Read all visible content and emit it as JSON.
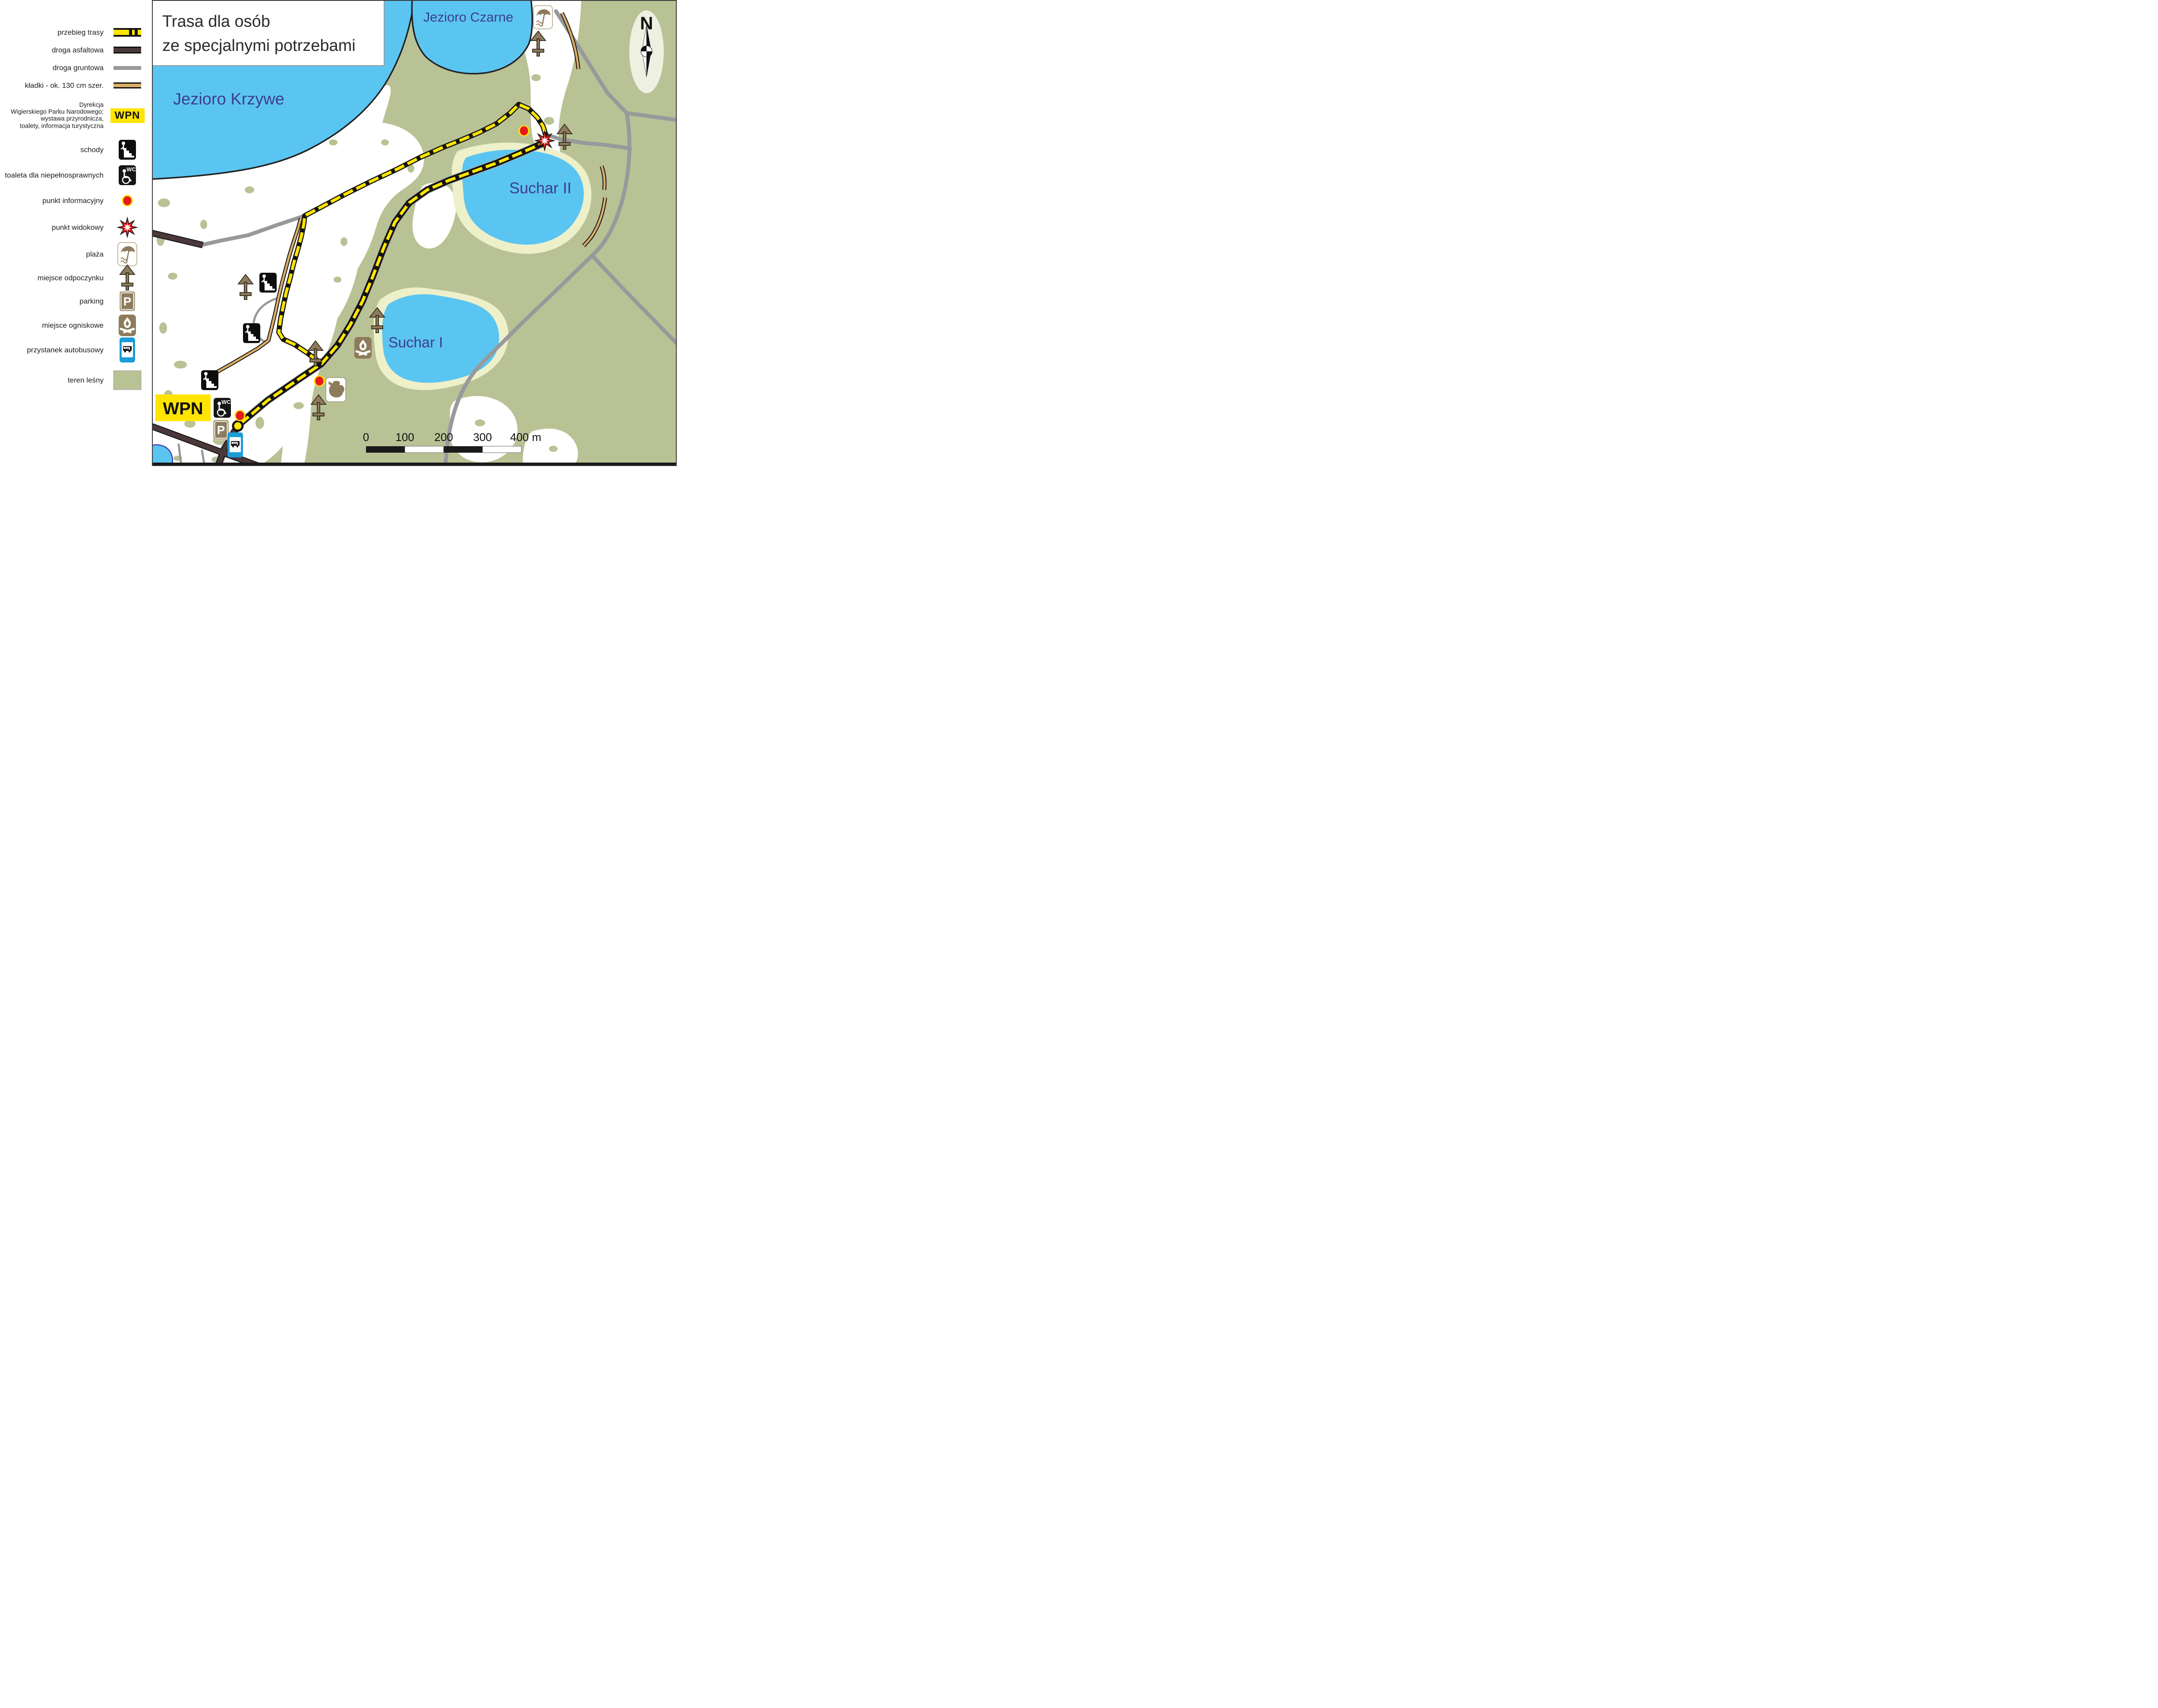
{
  "title": {
    "line1": "Trasa dla osób",
    "line2": "ze specjalnymi potrzebami"
  },
  "legend": {
    "items": [
      {
        "label": "przebieg trasy"
      },
      {
        "label": "droga asfaltowa"
      },
      {
        "label": "droga gruntowa"
      },
      {
        "label": "kładki - ok. 130 cm szer."
      },
      {
        "label": "Dyrekcja Wigierskiego Parku Narodowego: wystawa przyrodnicza, toalety, informacja turystyczna",
        "lines": [
          "Dyrekcja",
          "Wigierskiego Parku Narodowego:",
          "wystawa przyrodnicza,",
          "toalety, informacja turystyczna"
        ],
        "badge": "WPN"
      },
      {
        "label": "schody"
      },
      {
        "label": "toaleta dla niepełnosprawnych",
        "icon_text": "WC"
      },
      {
        "label": "punkt informacyjny"
      },
      {
        "label": "punkt widokowy"
      },
      {
        "label": "plaża"
      },
      {
        "label": "miejsce odpoczynku"
      },
      {
        "label": "parking",
        "icon_text": "P"
      },
      {
        "label": "miejsce ogniskowe"
      },
      {
        "label": "przystanek autobusowy"
      },
      {
        "label": "teren leśny"
      }
    ]
  },
  "map": {
    "labels": {
      "jezioro_krzywe": "Jezioro Krzywe",
      "jezioro_czarne": "Jezioro Czarne",
      "suchar_2": "Suchar II",
      "suchar_1": "Suchar I",
      "wpn": "WPN"
    },
    "icon_texts": {
      "wc": "WC",
      "parking": "P"
    },
    "compass": {
      "north": "N"
    },
    "scalebar": {
      "labels": [
        "0",
        "100",
        "200",
        "300",
        "400 m"
      ]
    },
    "colors": {
      "forest": "#b8c295",
      "water": "#5bc5f2",
      "sand": "#eef0ca",
      "trail_yellow": "#ffe500",
      "asphalt_road": "#4b383a",
      "dirt_road": "#98999b",
      "boardwalk": "#dcae66",
      "lake_label": "#3d3d8f",
      "icon_brown": "#8d7c5c",
      "bus_blue": "#1b9cd9",
      "info_red": "#e8191c",
      "wpn_yellow": "#ffe500"
    }
  }
}
